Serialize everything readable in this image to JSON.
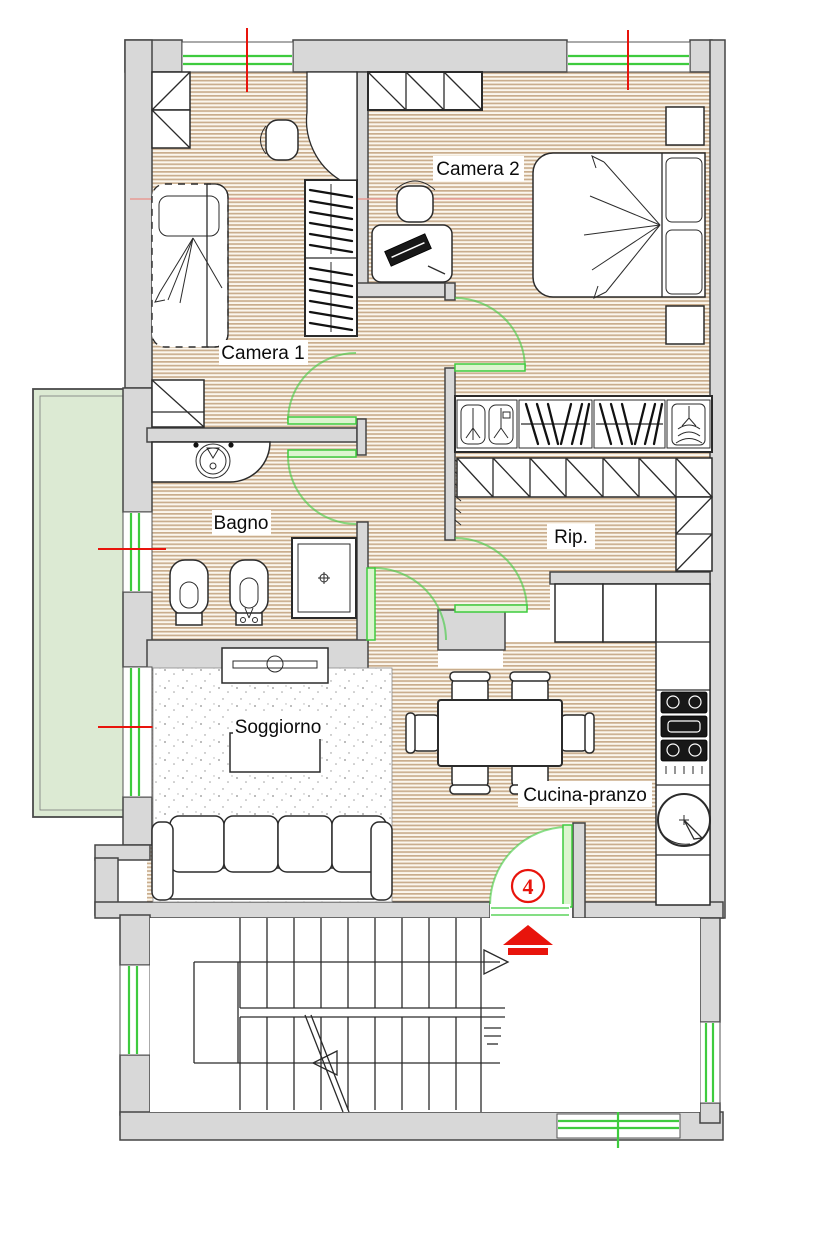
{
  "title": "Apartment floor plan",
  "rooms": {
    "camera1": "Camera 1",
    "camera2": "Camera 2",
    "bagno": "Bagno",
    "rip": "Rip.",
    "soggiorno": "Soggiorno",
    "cucina": "Cucina-pranzo"
  },
  "markers": {
    "unit_number": "4"
  },
  "colors": {
    "wall_fill": "#d8d8d8",
    "wall_stroke": "#454545",
    "floor_stripe": "#c9ad8d",
    "floor_bg": "#fbf6ed",
    "balcony_fill": "#dcead3",
    "fixture_green": "#3ecb3e",
    "leaf_fill": "#dcf5cf",
    "accent_red": "#e8140c",
    "section_pink": "#e89a94",
    "line_dark": "#2b2b2b"
  }
}
